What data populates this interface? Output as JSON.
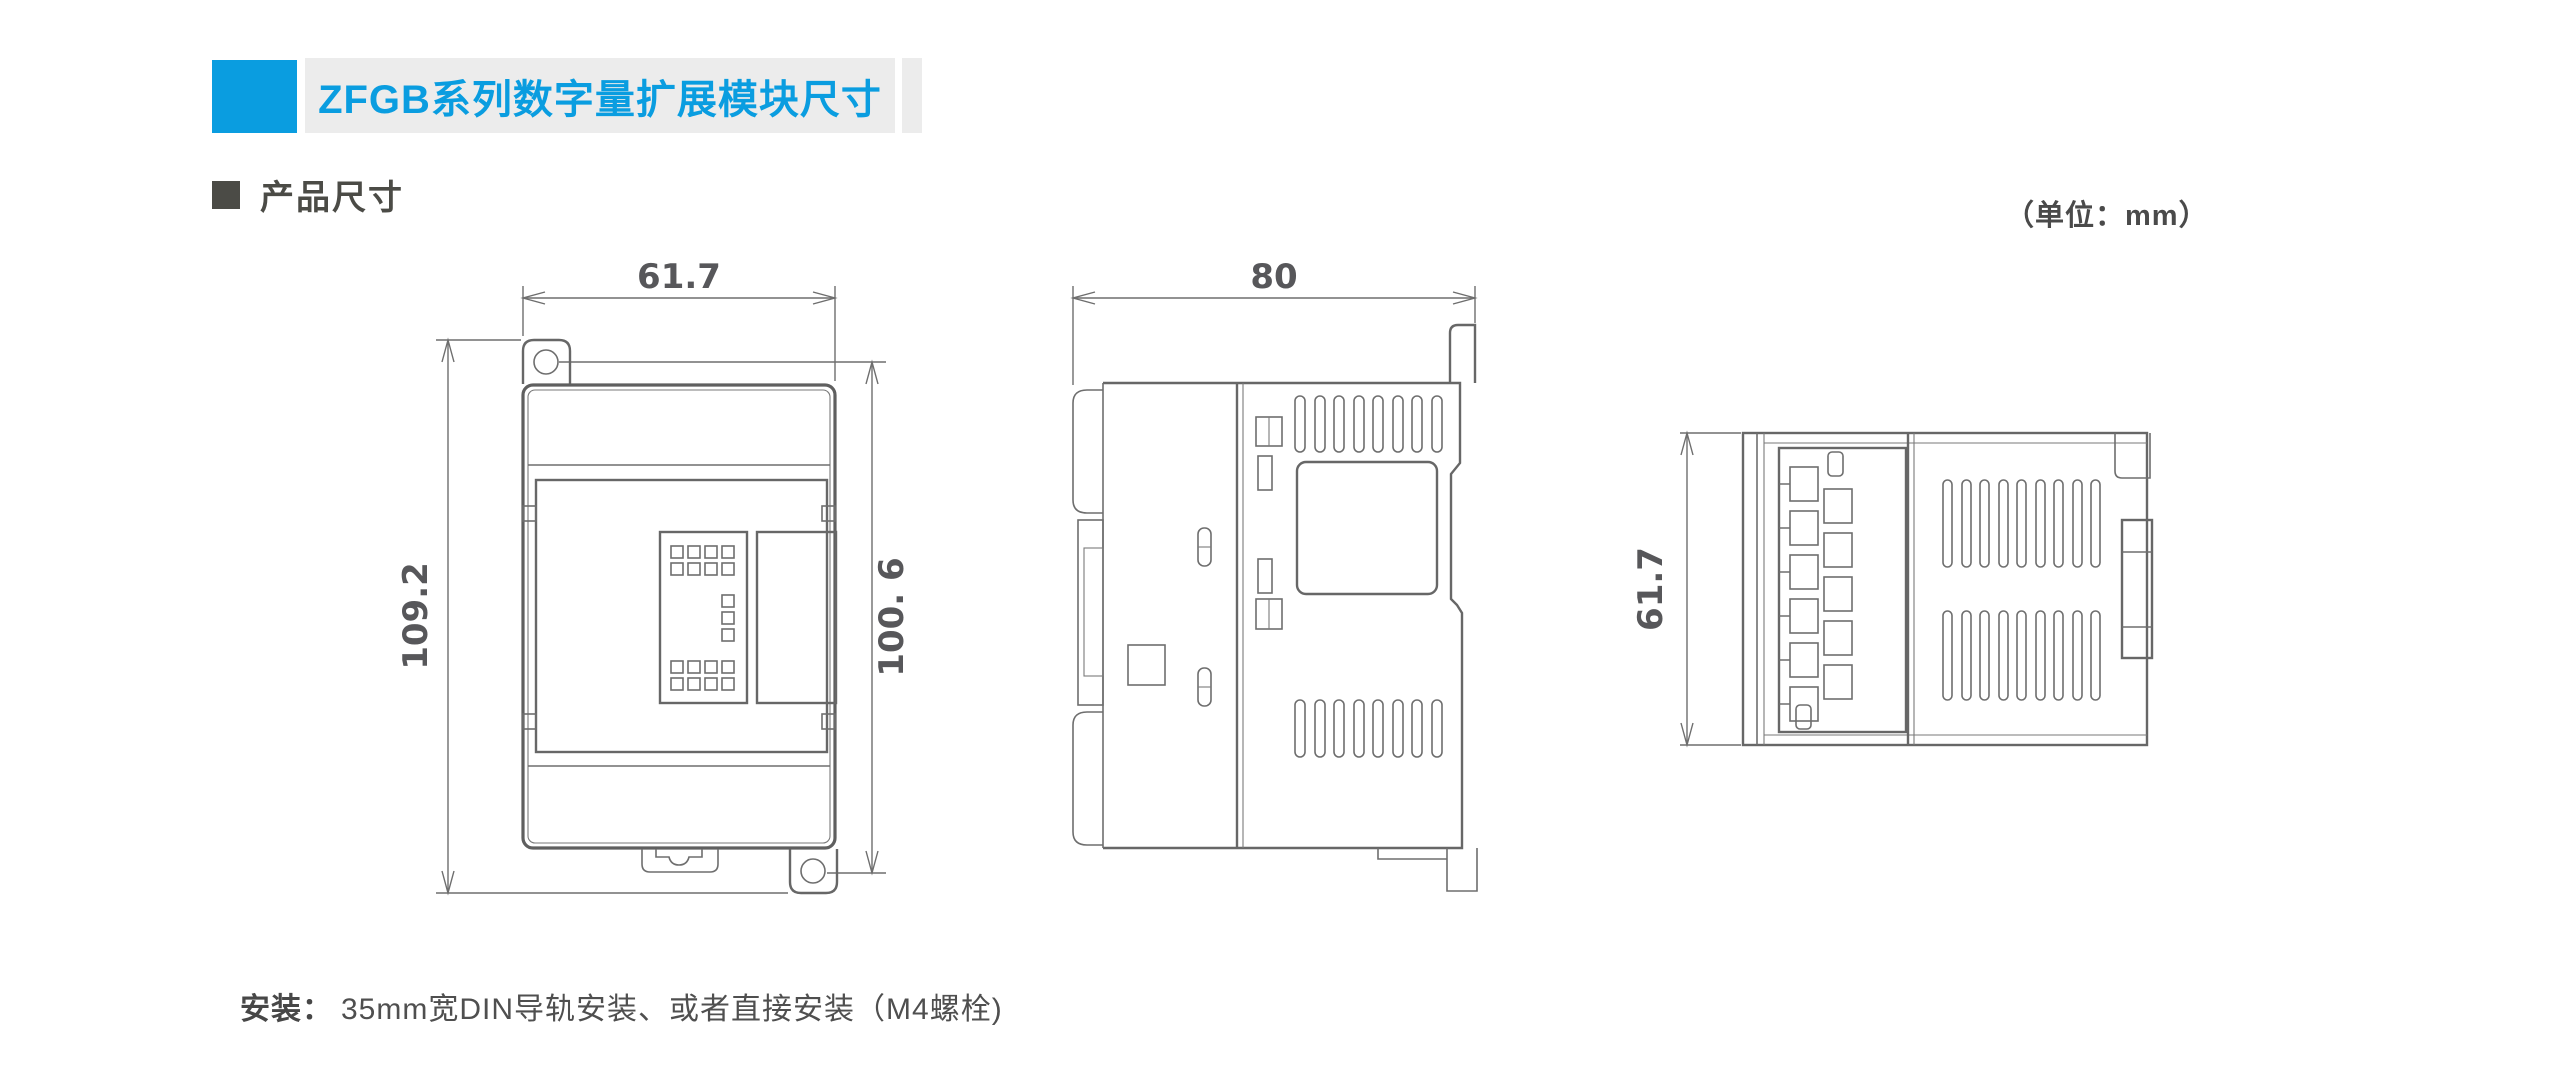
{
  "header": {
    "title": "ZFGB系列数字量扩展模块尺寸",
    "accent_color": "#0a9de0",
    "bar_color": "#ececec"
  },
  "section": {
    "heading": "产品尺寸",
    "units_note": "（单位：mm）"
  },
  "drawing": {
    "line_color": "#6e6e6e",
    "front_view": {
      "width": "61.7",
      "overall_height": "109.2",
      "hole_span_height": "100. 6"
    },
    "side_view": {
      "depth": "80"
    },
    "top_view": {
      "height": "61.7"
    }
  },
  "footer": {
    "install_label": "安装：",
    "install_text": "35mm宽DIN导轨安装、或者直接安装（M4螺栓)"
  }
}
